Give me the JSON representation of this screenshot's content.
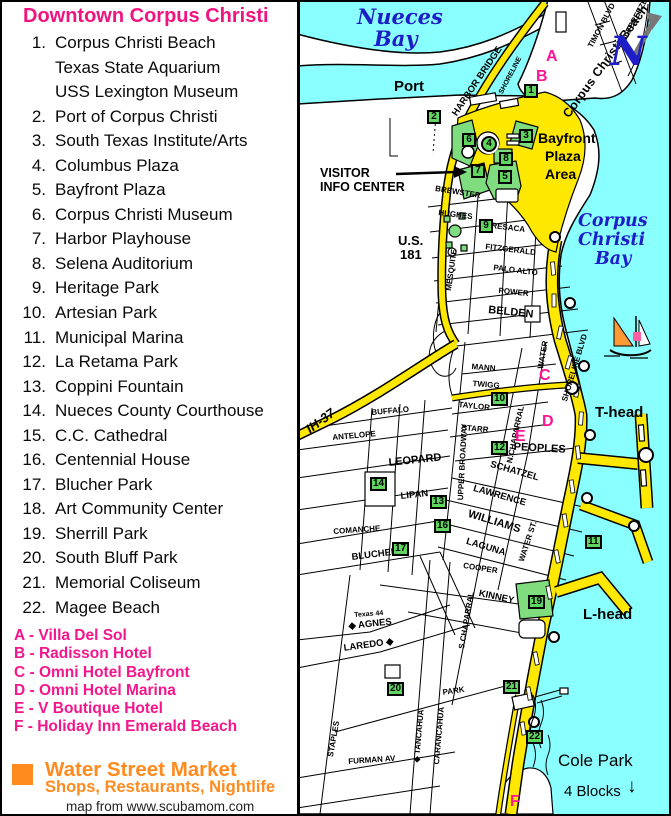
{
  "legend": {
    "title": "Downtown Corpus Christi",
    "items": [
      {
        "num": "1.",
        "lines": [
          "Corpus Christi Beach",
          "Texas State Aquarium",
          "USS Lexington Museum"
        ]
      },
      {
        "num": "2.",
        "lines": [
          "Port of Corpus Christi"
        ]
      },
      {
        "num": "3.",
        "lines": [
          "South Texas Institute/Arts"
        ]
      },
      {
        "num": "4.",
        "lines": [
          "Columbus Plaza"
        ]
      },
      {
        "num": "5.",
        "lines": [
          "Bayfront Plaza"
        ]
      },
      {
        "num": "6.",
        "lines": [
          "Corpus Christi Museum"
        ]
      },
      {
        "num": "7.",
        "lines": [
          "Harbor Playhouse"
        ]
      },
      {
        "num": "8.",
        "lines": [
          "Selena Auditorium"
        ]
      },
      {
        "num": "9.",
        "lines": [
          "Heritage Park"
        ]
      },
      {
        "num": "10.",
        "lines": [
          "Artesian Park"
        ]
      },
      {
        "num": "11.",
        "lines": [
          "Municipal Marina"
        ]
      },
      {
        "num": "12.",
        "lines": [
          "La Retama Park"
        ]
      },
      {
        "num": "13.",
        "lines": [
          "Coppini Fountain"
        ]
      },
      {
        "num": "14.",
        "lines": [
          "Nueces County Courthouse"
        ]
      },
      {
        "num": "15.",
        "lines": [
          "C.C. Cathedral"
        ]
      },
      {
        "num": "16.",
        "lines": [
          "Centennial House"
        ]
      },
      {
        "num": "17.",
        "lines": [
          "Blucher Park"
        ]
      },
      {
        "num": "18.",
        "lines": [
          "Art Community Center"
        ]
      },
      {
        "num": "19.",
        "lines": [
          "Sherrill Park"
        ]
      },
      {
        "num": "20.",
        "lines": [
          "South Bluff Park"
        ]
      },
      {
        "num": "21.",
        "lines": [
          "Memorial Coliseum"
        ]
      },
      {
        "num": "22.",
        "lines": [
          "Magee Beach"
        ]
      }
    ],
    "hotels": [
      "A - Villa Del Sol",
      "B - Radisson Hotel",
      "C - Omni Hotel Bayfront",
      "D - Omni Hotel Marina",
      "E - V Boutique Hotel",
      "F - Holiday Inn Emerald Beach"
    ],
    "market": {
      "title": "Water Street Market",
      "subtitle": "Shops, Restaurants, Nightlife"
    },
    "credit": "map from www.scubamom.com"
  },
  "map": {
    "colors": {
      "water": "#8AFFFF",
      "road_yellow": "#FFE800",
      "marker_green": "#5FD75F",
      "accent_pink": "#FF1493",
      "legend_pink": "#F0147E",
      "orange": "#FF8A1E",
      "label_blue": "#1E1EC8"
    },
    "street_labels": [
      {
        "t": "BREWSTER",
        "x": 436,
        "y": 184,
        "r": 9
      },
      {
        "t": "HUGHES",
        "x": 439,
        "y": 208,
        "r": 7
      },
      {
        "t": "RESACA",
        "x": 492,
        "y": 221,
        "r": 7
      },
      {
        "t": "FITZGERALD",
        "x": 486,
        "y": 242,
        "r": 7
      },
      {
        "t": "PALO ALTO",
        "x": 494,
        "y": 263,
        "r": 7
      },
      {
        "t": "POWER",
        "x": 499,
        "y": 286,
        "r": 6
      },
      {
        "t": "BELDEN",
        "x": 489,
        "y": 304,
        "r": 6,
        "c": "stl"
      },
      {
        "t": "MANN",
        "x": 472,
        "y": 362,
        "r": 5
      },
      {
        "t": "TWIGG",
        "x": 473,
        "y": 379,
        "r": 5
      },
      {
        "t": "TAYLOR",
        "x": 459,
        "y": 400,
        "r": 6
      },
      {
        "t": "STARR",
        "x": 462,
        "y": 423,
        "r": 5
      },
      {
        "t": "PEOPLES",
        "x": 514,
        "y": 441,
        "r": 3,
        "c": "stl"
      },
      {
        "t": "SCHATZEL",
        "x": 492,
        "y": 459,
        "r": 16,
        "c": "stm"
      },
      {
        "t": "LAWRENCE",
        "x": 475,
        "y": 483,
        "r": 16,
        "c": "stm"
      },
      {
        "t": "WILLIAMS",
        "x": 470,
        "y": 508,
        "r": 17,
        "c": "stl"
      },
      {
        "t": "LAGUNA",
        "x": 468,
        "y": 536,
        "r": 17,
        "c": "stm"
      },
      {
        "t": "COOPER",
        "x": 464,
        "y": 561,
        "r": 9
      },
      {
        "t": "KINNEY",
        "x": 480,
        "y": 588,
        "r": 12,
        "c": "stm"
      },
      {
        "t": "BUFFALO",
        "x": 371,
        "y": 408,
        "r": -5
      },
      {
        "t": "ANTELOPE",
        "x": 332,
        "y": 433,
        "r": -5
      },
      {
        "t": "LEOPARD",
        "x": 388,
        "y": 457,
        "r": -6,
        "c": "stl"
      },
      {
        "t": "LIPAN",
        "x": 400,
        "y": 491,
        "r": -6,
        "c": "stm"
      },
      {
        "t": "COMANCHE",
        "x": 333,
        "y": 527,
        "r": -4
      },
      {
        "t": "BLUCHER",
        "x": 351,
        "y": 552,
        "r": -7,
        "c": "stm"
      },
      {
        "t": "Texas 44",
        "x": 354,
        "y": 612,
        "r": -4,
        "c": "sts"
      },
      {
        "t": "◆ AGNES",
        "x": 348,
        "y": 621,
        "r": -6,
        "c": "stm"
      },
      {
        "t": "LAREDO ◆",
        "x": 343,
        "y": 643,
        "r": -8,
        "c": "stm"
      },
      {
        "t": "PARK",
        "x": 442,
        "y": 688,
        "r": -8
      },
      {
        "t": "FURMAN AV",
        "x": 348,
        "y": 757,
        "r": -4
      },
      {
        "t": "MESQUITE",
        "x": 444,
        "y": 290,
        "r": -82
      },
      {
        "t": "UPPER BROADWAY",
        "x": 456,
        "y": 500,
        "r": -87
      },
      {
        "t": "N.CHAPARRAL",
        "x": 505,
        "y": 462,
        "r": -78
      },
      {
        "t": "WATER",
        "x": 536,
        "y": 368,
        "r": -80
      },
      {
        "t": "WATER ST.",
        "x": 517,
        "y": 560,
        "r": -72
      },
      {
        "t": "S.CHAPARRAL",
        "x": 457,
        "y": 648,
        "r": -80
      },
      {
        "t": "◆ TANCAHUA",
        "x": 412,
        "y": 762,
        "r": -85
      },
      {
        "t": "CARANCAHUA",
        "x": 432,
        "y": 764,
        "r": -85
      },
      {
        "t": "STAPLES",
        "x": 326,
        "y": 756,
        "r": -80
      },
      {
        "t": "SHORELINE BLVD",
        "x": 560,
        "y": 400,
        "r": -73
      },
      {
        "t": "TIMON BLVD",
        "x": 586,
        "y": 45,
        "r": -62
      },
      {
        "t": "GULFBREEZE",
        "x": 616,
        "y": 45,
        "r": -62
      },
      {
        "t": "SHORELINE",
        "x": 498,
        "y": 92,
        "r": -62,
        "c": "sts"
      },
      {
        "t": "HARBOR BRIDGE",
        "x": 450,
        "y": 112,
        "r": -56,
        "c": "stm"
      },
      {
        "t": "Corpus Christi Beach",
        "x": 560,
        "y": 112,
        "r": -54,
        "c": "beach"
      }
    ],
    "texts": [
      {
        "t": "VISITOR",
        "x": 320,
        "y": 166,
        "c": "vic"
      },
      {
        "t": "INFO CENTER",
        "x": 320,
        "y": 180,
        "c": "vic"
      },
      {
        "t": "Port",
        "x": 394,
        "y": 78,
        "c": "port"
      },
      {
        "t": "U.S.",
        "x": 398,
        "y": 233,
        "c": "hwy"
      },
      {
        "t": "181",
        "x": 400,
        "y": 247,
        "c": "hwy"
      },
      {
        "t": "IH-37",
        "x": 303,
        "y": 424,
        "r": -36,
        "c": "ih"
      },
      {
        "t": "Bayfront",
        "x": 538,
        "y": 130,
        "c": "plaza"
      },
      {
        "t": "Plaza",
        "x": 545,
        "y": 148,
        "c": "plaza"
      },
      {
        "t": "Area",
        "x": 545,
        "y": 166,
        "c": "plaza"
      },
      {
        "t": "T-head",
        "x": 595,
        "y": 404,
        "c": "head"
      },
      {
        "t": "L-head",
        "x": 583,
        "y": 606,
        "c": "head"
      },
      {
        "t": "Cole Park",
        "x": 558,
        "y": 751,
        "c": "cole"
      },
      {
        "t": "4 Blocks",
        "x": 564,
        "y": 783,
        "c": "cole2"
      },
      {
        "t": "↓",
        "x": 627,
        "y": 776,
        "c": "darr"
      },
      {
        "t": "Nueces",
        "x": 357,
        "y": 4,
        "c": "bay"
      },
      {
        "t": "Bay",
        "x": 374,
        "y": 26,
        "c": "bay"
      },
      {
        "t": "Corpus",
        "x": 578,
        "y": 211,
        "c": "bay2"
      },
      {
        "t": "Christi",
        "x": 578,
        "y": 230,
        "c": "bay2"
      },
      {
        "t": "Bay",
        "x": 595,
        "y": 249,
        "c": "bay2"
      },
      {
        "t": "N",
        "x": 610,
        "y": 28,
        "c": "north"
      }
    ],
    "markers": [
      {
        "n": "1",
        "x": 524,
        "y": 84
      },
      {
        "n": "2",
        "x": 427,
        "y": 110
      },
      {
        "n": "3",
        "x": 519,
        "y": 129
      },
      {
        "n": "4",
        "x": 481,
        "y": 136,
        "shape": "circle"
      },
      {
        "n": "5",
        "x": 498,
        "y": 170
      },
      {
        "n": "6",
        "x": 462,
        "y": 133
      },
      {
        "n": "7",
        "x": 471,
        "y": 164
      },
      {
        "n": "8",
        "x": 499,
        "y": 152
      },
      {
        "n": "9",
        "x": 479,
        "y": 219
      },
      {
        "n": "10",
        "x": 491,
        "y": 392
      },
      {
        "n": "11",
        "x": 585,
        "y": 535
      },
      {
        "n": "12",
        "x": 491,
        "y": 441
      },
      {
        "n": "13",
        "x": 430,
        "y": 495
      },
      {
        "n": "14",
        "x": 370,
        "y": 477
      },
      {
        "n": "16",
        "x": 434,
        "y": 519
      },
      {
        "n": "17",
        "x": 392,
        "y": 542
      },
      {
        "n": "19",
        "x": 528,
        "y": 595
      },
      {
        "n": "20",
        "x": 387,
        "y": 682
      },
      {
        "n": "21",
        "x": 503,
        "y": 680
      },
      {
        "n": "22",
        "x": 526,
        "y": 730
      }
    ],
    "letters": [
      {
        "t": "A",
        "x": 546,
        "y": 48
      },
      {
        "t": "B",
        "x": 536,
        "y": 68
      },
      {
        "t": "C",
        "x": 539,
        "y": 367
      },
      {
        "t": "D",
        "x": 542,
        "y": 413
      },
      {
        "t": "E",
        "x": 515,
        "y": 428
      },
      {
        "t": "F",
        "x": 510,
        "y": 793
      }
    ]
  }
}
